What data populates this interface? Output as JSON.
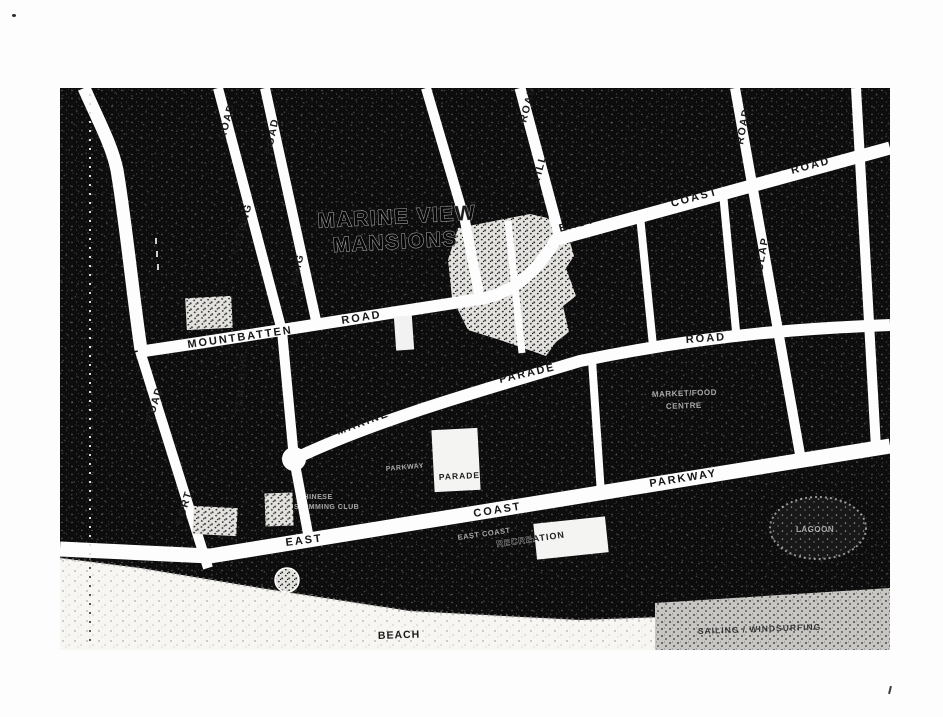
{
  "map": {
    "title": {
      "line1": "MARINE VIEW",
      "line2": "MANSIONS"
    },
    "roads": {
      "katong": {
        "name": "KATONG",
        "road": "ROAD"
      },
      "haig": {
        "name": "HAIG",
        "road": "ROAD"
      },
      "still": {
        "name": "STILL",
        "road": "ROAD"
      },
      "siglap": {
        "name": "SIGLAP",
        "road": "ROAD"
      },
      "fort": {
        "name": "FORT",
        "road": "ROAD"
      },
      "tanjong": {
        "name": "TANJONG"
      },
      "mountbatten": {
        "name": "MOUNTBATTEN",
        "road": "ROAD"
      },
      "east_coast_road": {
        "east": "EAST",
        "coast": "COAST",
        "road": "ROAD"
      },
      "marine_parade_road": {
        "marine": "MARINE",
        "parade": "PARADE",
        "road": "ROAD"
      },
      "east_coast_parkway": {
        "east": "EAST",
        "coast": "COAST",
        "parkway": "PARKWAY"
      }
    },
    "places": {
      "chinese_swimming_club": {
        "line1": "CHINESE",
        "line2": "SWIMMING CLUB"
      },
      "parkway_parade": {
        "label": "PARKWAY",
        "building": "PARADE"
      },
      "market_food_centre": {
        "line1": "MARKET/FOOD",
        "line2": "CENTRE"
      },
      "recreation_centre": {
        "prefix": "EAST COAST",
        "name": "RECREATION"
      },
      "lagoon": "LAGOON",
      "beach": "BEACH",
      "sailing": "SAILING / WINDSURFING"
    },
    "colors": {
      "ground": "#0d0d0d",
      "road": "#fdfdfd",
      "sand": "#f7f6f2",
      "sea": "#c7c6c3",
      "stipple_light": "#e3e2df",
      "text_dark": "#161616"
    }
  }
}
